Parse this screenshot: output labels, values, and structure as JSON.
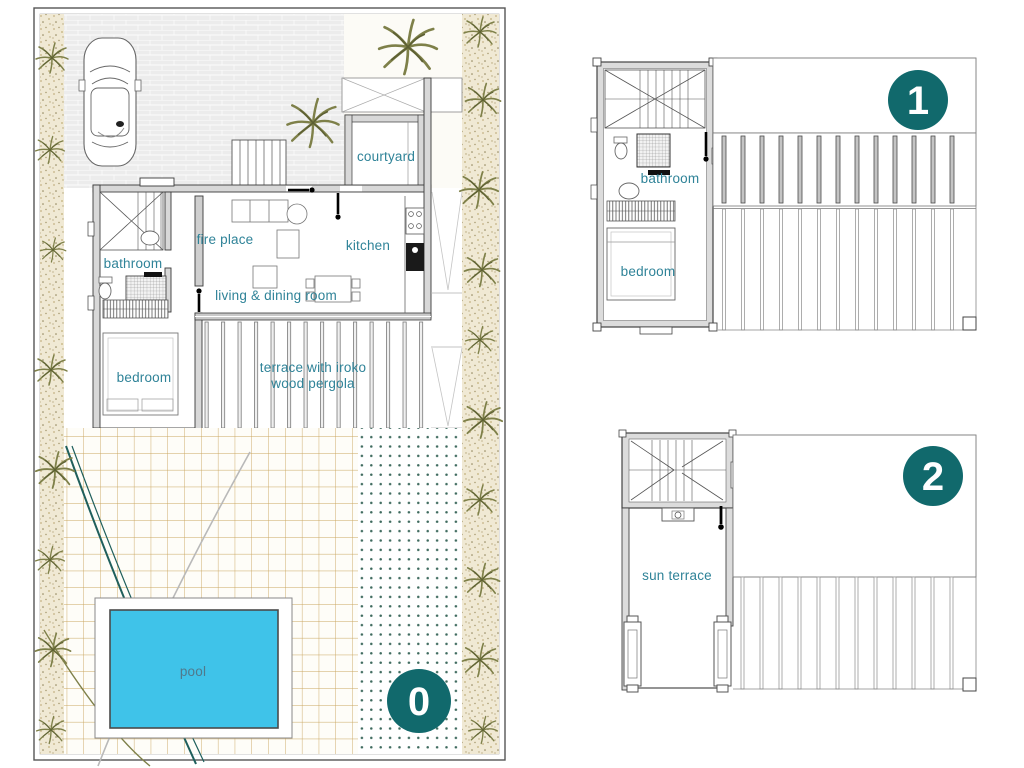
{
  "colors": {
    "label_text": "#2f8398",
    "pool_label_text": "#50798c",
    "badge_fill": "#11696c",
    "badge_text": "#ffffff",
    "pool_water": "#3fc3e9",
    "patio_grid_line": "#c9a55e",
    "dot_color": "#3e6a5e",
    "vegetation_frond": "#7e8049",
    "wall_edge": "#3a3a3a",
    "wall_fill": "#d8d8d8"
  },
  "floors": {
    "ground": {
      "badge": "0",
      "labels": {
        "courtyard": "courtyard",
        "fire_place": "fire place",
        "kitchen": "kitchen",
        "bathroom": "bathroom",
        "living_dining": "living & dining room",
        "bedroom": "bedroom",
        "terrace_line1": "terrace with iroko",
        "terrace_line2": "wood pergola",
        "pool": "pool"
      }
    },
    "first": {
      "badge": "1",
      "labels": {
        "bathroom": "bathroom",
        "bedroom": "bedroom"
      }
    },
    "second": {
      "badge": "2",
      "labels": {
        "sun_terrace": "sun terrace"
      }
    }
  }
}
